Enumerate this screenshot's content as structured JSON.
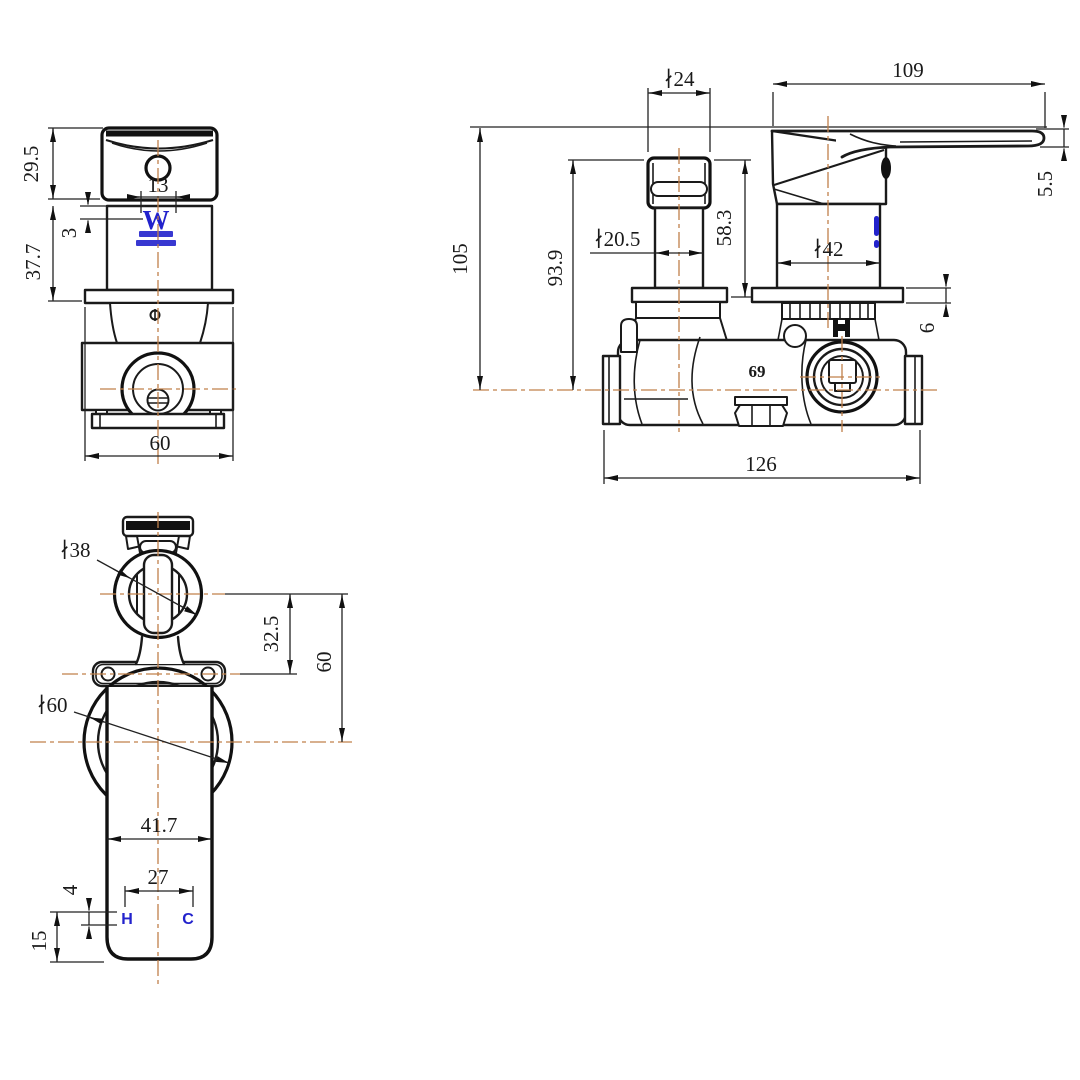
{
  "views": {
    "front_view": {
      "dim_cap_height": "29.5",
      "dim_logo_width": "13",
      "dim_logo_offset": "3",
      "dim_body_height": "37.7",
      "dim_plate_width": "60",
      "watermark_letter": "W"
    },
    "side_view": {
      "dim_stem_cap_dia": "∤24",
      "dim_lever_length": "109",
      "dim_lever_thickness": "5.5",
      "dim_total_height": "105",
      "dim_stem_height": "93.9",
      "dim_stem_dia": "∤20.5",
      "dim_cap_to_flange": "58.3",
      "dim_handle_dia": "∤42",
      "dim_flange_thickness": "6",
      "dim_body_width": "126",
      "body_marking": "69"
    },
    "top_view": {
      "dim_knob_dia": "∤38",
      "dim_knob_to_lug": "32.5",
      "dim_knob_to_center": "60",
      "dim_escutcheon_dia": "∤60",
      "dim_lever_width": "41.7",
      "dim_port_spacing": "27",
      "dim_port_offset": "4",
      "dim_port_inset": "15",
      "hot_label": "H",
      "cold_label": "C"
    }
  },
  "colors": {
    "line": "#1a1a1a",
    "dimension": "#222222",
    "centerline": "#c0804a",
    "accent_blue": "#2222cc",
    "background": "#ffffff"
  }
}
